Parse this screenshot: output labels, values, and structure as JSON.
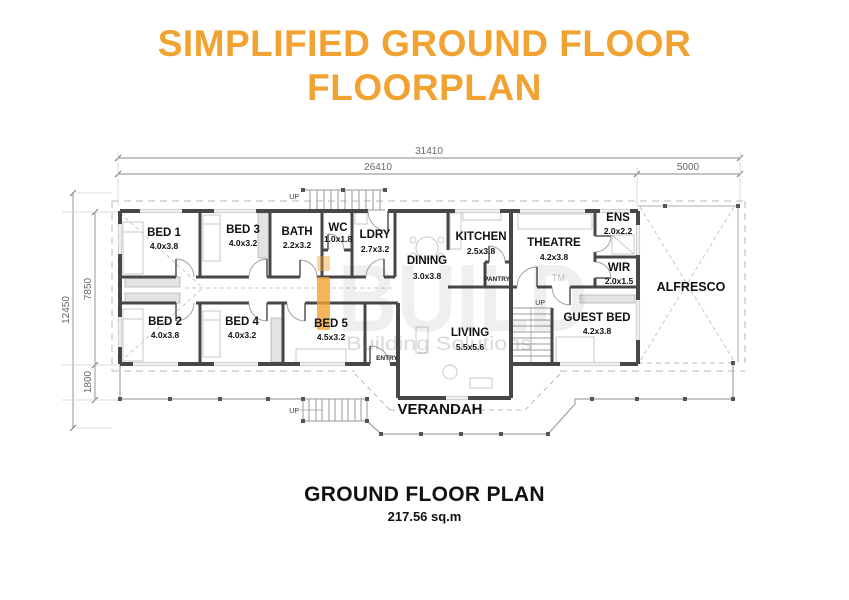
{
  "title": {
    "line1": "SIMPLIFIED GROUND FLOOR",
    "line2": "FLOORPLAN"
  },
  "colors": {
    "accent_orange": "#F2A230",
    "wall": "#474747",
    "dim_line": "#8a8a8a"
  },
  "dimensions": {
    "top": {
      "total": "31410",
      "main": "26410",
      "right": "5000"
    },
    "left": {
      "total": "12450",
      "main": "7850",
      "lower": "1800"
    }
  },
  "plan": {
    "rooms": [
      {
        "name": "BED 1",
        "size": "4.0x3.8"
      },
      {
        "name": "BED 3",
        "size": "4.0x3.2"
      },
      {
        "name": "BATH",
        "size": "2.2x3.2"
      },
      {
        "name": "WC",
        "size": "1.0x1.8"
      },
      {
        "name": "LDRY",
        "size": "2.7x3.2"
      },
      {
        "name": "DINING",
        "size": "3.0x3.8"
      },
      {
        "name": "KITCHEN",
        "size": "2.5x3.8"
      },
      {
        "name": "THEATRE",
        "size": "4.2x3.8"
      },
      {
        "name": "ENS",
        "size": "2.0x2.2"
      },
      {
        "name": "WIR",
        "size": "2.0x1.5"
      },
      {
        "name": "ALFRESCO",
        "size": ""
      },
      {
        "name": "BED 2",
        "size": "4.0x3.8"
      },
      {
        "name": "BED 4",
        "size": "4.0x3.2"
      },
      {
        "name": "BED 5",
        "size": "4.5x3.2"
      },
      {
        "name": "LIVING",
        "size": "5.5x5.6"
      },
      {
        "name": "GUEST BED",
        "size": "4.2x3.8"
      },
      {
        "name": "VERANDAH",
        "size": ""
      }
    ],
    "annotations": {
      "pantry": "PANTRY",
      "entry": "ENTRY",
      "up": "UP"
    }
  },
  "watermark": {
    "brand_i": "i",
    "brand": "BUILD",
    "tagline": "Building Solutions",
    "tm": "TM"
  },
  "caption": {
    "title": "GROUND FLOOR PLAN",
    "area": "217.56 sq.m"
  }
}
